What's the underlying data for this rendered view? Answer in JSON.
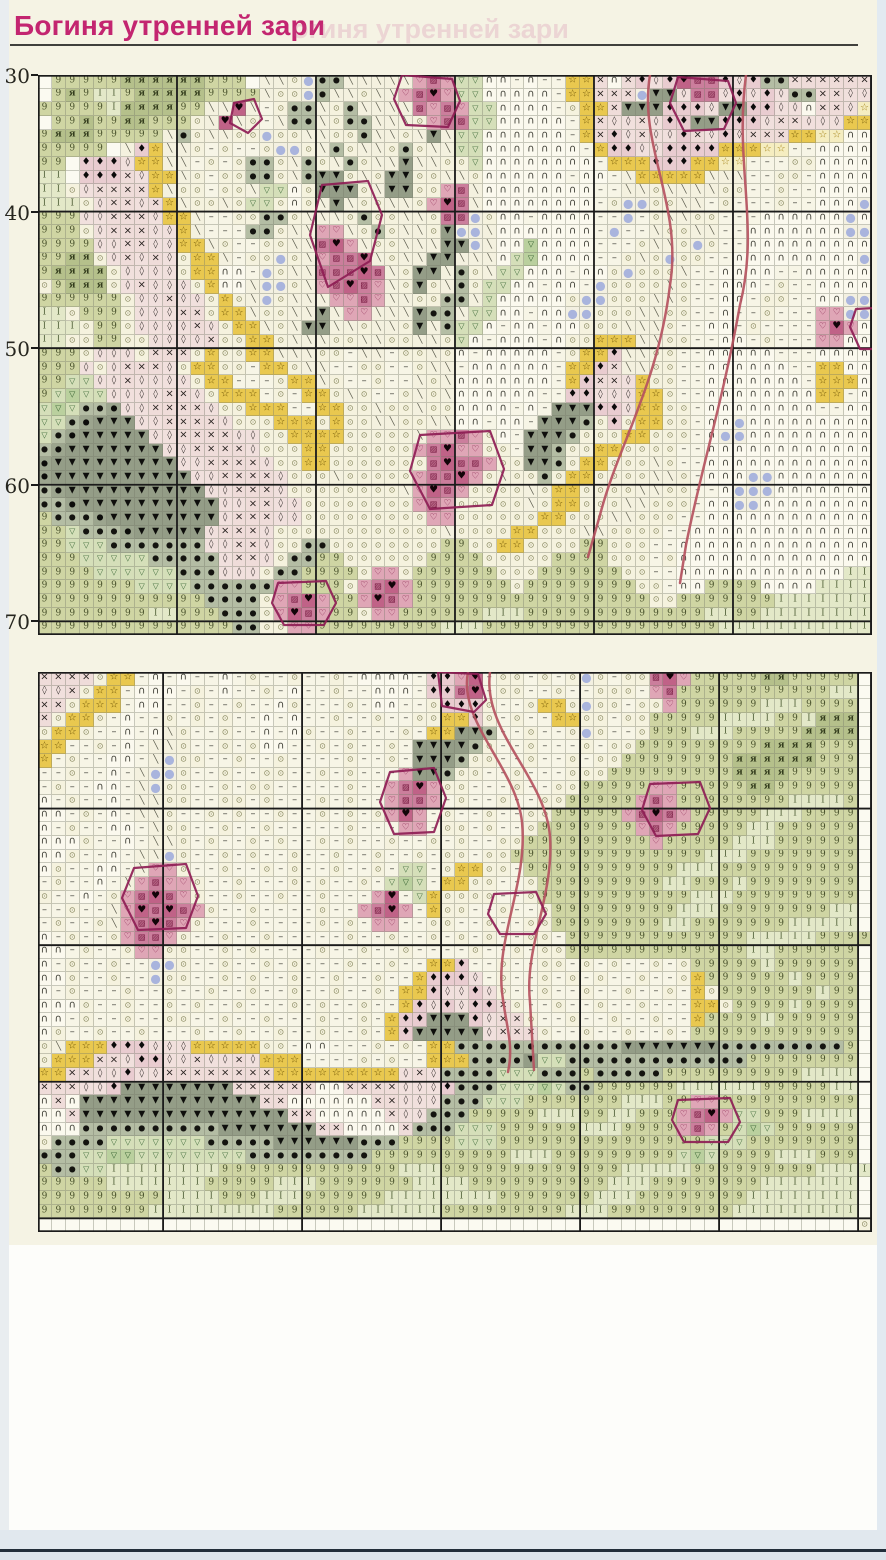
{
  "title": "Богиня утренней зари",
  "ghost_title": "огиня утренней зари",
  "title_color": "#c32570",
  "row_axis": {
    "labels": [
      "30",
      "40",
      "50",
      "60",
      "70"
    ],
    "label_rows": [
      0,
      10,
      20,
      30,
      40
    ]
  },
  "legend": {
    "w": {
      "name": "empty",
      "bg": "#fbfaf1",
      "fg": "#000000",
      "sym": "",
      "fs": 8
    },
    ".": {
      "name": "circled-dot-stitch",
      "bg": "#f5f2de",
      "fg": "#85855c",
      "sym": "⊙",
      "fs": 8
    },
    "-": {
      "name": "dash-stitch",
      "bg": "#f7f5e6",
      "fg": "#46463e",
      "sym": "–",
      "fs": 10
    },
    "n": {
      "name": "arc-stitch",
      "bg": "#fbf9ee",
      "fg": "#38382f",
      "sym": "∩",
      "fs": 10
    },
    "p": {
      "name": "pin-stitch",
      "bg": "#f4f1df",
      "fg": "#5c5c4e",
      "sym": "╲",
      "fs": 9
    },
    "9": {
      "name": "leaf-light-nine",
      "bg": "#cfd5a3",
      "fg": "#47502a",
      "sym": "9",
      "fs": 9,
      "serif": true
    },
    "A": {
      "name": "leaf-dark-ya",
      "bg": "#b5c08b",
      "fg": "#333c1c",
      "sym": "я",
      "fs": 9,
      "serif": true,
      "bold": true
    },
    "I": {
      "name": "leaf-pale-I",
      "bg": "#e3e8c8",
      "fg": "#57663e",
      "sym": "I",
      "fs": 9,
      "serif": true
    },
    "e": {
      "name": "sage-eye-dot",
      "bg": "#b4bda4",
      "fg": "#141410",
      "sym": "●",
      "fs": 8
    },
    "E": {
      "name": "sage-dark-eye-dot",
      "bg": "#9ca58e",
      "fg": "#0c0c0a",
      "sym": "●",
      "fs": 8
    },
    "T": {
      "name": "dark-triangle",
      "bg": "#949d87",
      "fg": "#0e0e0c",
      "sym": "▼",
      "fs": 9
    },
    "v": {
      "name": "green-triangle-light",
      "bg": "#d5dfb9",
      "fg": "#3f6b3a",
      "sym": "▽",
      "fs": 8
    },
    "V": {
      "name": "green-triangle-mid",
      "bg": "#bad09e",
      "fg": "#2e5c2b",
      "sym": "▽",
      "fs": 8
    },
    "y": {
      "name": "gold-star",
      "bg": "#e9c84f",
      "fg": "#6e5404",
      "sym": "☆",
      "fs": 10
    },
    "Y": {
      "name": "pale-star",
      "bg": "#f5edc0",
      "fg": "#a5841a",
      "sym": "☆",
      "fs": 10
    },
    "x": {
      "name": "pink-cross",
      "bg": "#efdcd9",
      "fg": "#26201e",
      "sym": "×",
      "fs": 10
    },
    "q": {
      "name": "pink-lozenge",
      "bg": "#f1e0dd",
      "fg": "#3a3432",
      "sym": "◊",
      "fs": 9
    },
    "D": {
      "name": "black-diamond",
      "bg": "#e9ccd0",
      "fg": "#0b0a0a",
      "sym": "♦",
      "fs": 10
    },
    "h": {
      "name": "rose-open-heart",
      "bg": "#dfa6b6",
      "fg": "#7c1240",
      "sym": "♡",
      "fs": 9
    },
    "r": {
      "name": "rose-hatch-square",
      "bg": "#cb7e9c",
      "fg": "#6e0f36",
      "sym": "▨",
      "fs": 8
    },
    "H": {
      "name": "rose-dark-heart",
      "bg": "#c06287",
      "fg": "#120408",
      "sym": "♥",
      "fs": 10
    },
    "b": {
      "name": "lavender-bead",
      "bg": "#f3f0e1",
      "fg": "#a9b4dd",
      "sym": "●",
      "fs": 12
    },
    "B": {
      "name": "lavender-bead-green",
      "bg": "#cdd7af",
      "fg": "#9fafdc",
      "sym": "●",
      "fs": 12
    }
  },
  "panels": [
    {
      "id": "panel1",
      "top": 75,
      "thick_cols": [
        0,
        10,
        20,
        30,
        40,
        50,
        60
      ],
      "thick_rows": [
        0,
        10,
        20,
        30,
        40
      ],
      "rows": [
        "w99999AAAAAA999wpp.beeppppphrhvvnn-n--yyxnxDqDHrrDqDeexxxxxx",
        "w9A9II9AAAAA9999p..bepp.pphrHhvvnnnnn-yyxxxbTTqrrqDqDqeexxqq",
        "99999IAAAA99ppHp-.eep.epppprhrhvvnnnn-.yyxTTTDDDqTTDDqqnxxqY",
        "w99A99AA999.pHp.-peep.eeppp.hrrvvnnnnn-yxqqxqDDTTDDDqxxqqqyy",
        "9AAA99999pe.pp..b..pp..epp.pTpvvnnnnnn-yxDqxqqDxqDqxxxyyYYnn",
        "99999wpDypp.-.--.bb.pe.pp.e.ppvvnnnnnnn-yDDqqDDDDyyyYY--nnnn",
        "99wDDDqyypp-.-.ee.pe.pe.ppTpp..vnnnnnnnn-yyyDDDyyYY---..nnnn",
        "IIwDDDxqyyp.-..ee.peTT.p.TT..pp.nnnnnn-nn-pyyyyyppp--..-nnnn",
        "II.qxxxxyp..-..pvvn.TTT.pTT..hrpnnnnnnnn--pp.pppp..--.--nnnn",
        "III.qxxqxyp..p.vv.n.pTp..pp.hHrpnnnnnnnn-.bb..pp-.---.--nnnb",
        "999qqxxxqyyp--..ee.ppp.e..pp.rrb.nn-nnnn--b-.pp..---nnnnnnbn",
        "999.qxxxqqyp---ee.pphhp.e.pp.Tbbpnnnnnnn-b--p..pp--nnnnnnnbb",
        "9999qqxxqqyyp.--..pprHhp..pppTTbpnnVnnnn---.pp.b.--nnnnnnnnn",
        "99AA.qxqxq.yyp-..b.phrrHp.ppTTpppnvVnnnn--.p.b..--nnnnnnnnnb",
        "9AAAA.qqqq.yynn-b.pprrrHrp.TTpe.pvvnnn-nn.b...p--nnnn--nnnnn",
        ".9AAA.qxqqq.ynnpbb.phrHrhp.T.pe.vvnn-nn-b....p.--nnn-.--nnnn",
        "999999.qqxqq.y.pb.ppphhrhpp..eepvnnnnn.bb...pp.--nn-..--nnbb",
        "II.999.qqqxx.yyp..ppTphhpppTeepvvnn-nnbb...pp..--n--.---hhbb",
        "III.99.qqqqxq.yyp.pTTpp.pp.Tpevvn-nn-nn...ppp.--nn-.----hHhn",
        "II..99..qqqqx..yy.ppp..pp..pp.vn-nnn-n..yyypp..--nn-.---hhnn",
        "999.qqq.xxx.y..yyppp..-pp-..p.n-nnnnn-.yyDpp..--nnnnn---nnnn",
        "999q.qxxxq.yy..-yy.pp--..--.pp-nnnnnn-yyDxpp..--nnnnnn--yynn",
        "99vvqqxqqqq.yy---.yyp.--.--p.pnnnnnnn-yDxxqy..--nnnnnnn-yyyn",
        "9vVvvqqqqxxq.yyy-.-yy.p.--.p.pnnnnnn--DDqqqyy.--nnnnnnnnyy-n",
        "vVveeEqqxxxxq..yyy--yy..p..p..nnnn-n-TTTDDqyy..-nnnnnnnn--nn",
        "vveETTTqqxxxxq...yyy.y..pp..ppnn-nn-TTTe.D.yy..-nnbnnnnnnnnn",
        "veETTTTTqqxxxxqq..yyyy.....phhrh.n-TTTe...yy...-nbbnnnnnnnnn",
        "eETTTTTTTqqxxxxq...yy......hrHhh..-TTe..yy....--nnnnnnnnnnnn",
        "ETTTTTTTTTqqxxxxq..yy.......rHrrh..TTe.yy...p.--nnnnnnnnnnnn",
        "ETTTTTTTTTTqqxxxxq...p.....hrrHh.p..e.yy....pp.-nnnbbnnnnnnn",
        "eETTTTTTTTTTqqxxxq........phHrh....p.yy....pp..--nbbbnnnnnnn",
        "eeETTTTTTTTTTqqxxqq........hrh.....p.yy...pp...-nnbbnnnnnnnn",
        "9eeeETTTTTTTTqxxxqq.........hh......yy...pp...--nnnnnnnnnnnn",
        "99veeeETTTTTqxxxq............p....yy...pp....--nnnnnnnnnnnnn",
        "99vvveeeeeeeqqxxq..ee........99..yy....99...--nnnnnnnnnnnnnn",
        "999vvvvveeeeeqxxq.ee99......9999.....9999...-.nnnnnnnnnnnnnn",
        "9999vvvvvveeeqqq.ee9999.hh.999999...999999..--nnnnnnnnnnnnII",
        "9999999vvvveeeeeehh999.hrHh9999999.99999999..-nn9999nnnnIIII",
        "999999999999eeee.hrHh99hHrh99999999999999999..9999999IIIIIII",
        "99999999II999eee.hHrh99.hh999999III9999999999999II99IIIIIIII",
        "99999999999999ee..hh999999999III99999999999999999IIIIIIIIIII"
      ],
      "backstitch": [
        {
          "color": "#b5525f",
          "width": 2.5,
          "path": "M612,0 C600,70 645,130 632,210 C620,310 580,370 562,440 L550,482"
        },
        {
          "color": "#b5525f",
          "width": 2.5,
          "path": "M708,0 C696,90 722,150 702,230 C684,330 664,390 648,470 L642,508"
        },
        {
          "color": "#8e1d55",
          "width": 2.2,
          "path": "M364,0 L414,4 L422,26 L410,52 L368,50 L356,24 Z"
        },
        {
          "color": "#8e1d55",
          "width": 2.2,
          "path": "M284,110 L330,106 L344,140 L332,186 L290,212 L272,160 Z"
        },
        {
          "color": "#8e1d55",
          "width": 2.2,
          "path": "M640,2 L690,6 L698,28 L686,54 L646,56 L632,28 Z"
        },
        {
          "color": "#8e1d55",
          "width": 2.2,
          "path": "M818,234 L856,232 L864,254 L854,274 L822,274 L812,252 Z"
        },
        {
          "color": "#8e1d55",
          "width": 2.2,
          "path": "M382,360 L452,356 L466,394 L454,430 L392,434 L372,396 Z"
        },
        {
          "color": "#8e1d55",
          "width": 2.2,
          "path": "M240,508 L288,506 L298,528 L286,550 L246,550 L234,528 Z"
        },
        {
          "color": "#8e1d55",
          "width": 2.2,
          "path": "M196,28 L216,24 L224,44 L210,58 L192,48 Z"
        }
      ]
    },
    {
      "id": "panel2",
      "top": 672,
      "thick_cols": [
        0,
        9,
        19,
        29,
        39,
        49,
        59,
        60
      ],
      "thick_rows": [
        0,
        10,
        20,
        30,
        40
      ],
      "rows": [
        "xxxx.yy-n-n--n-.--.--.-nnnn-DDhH-..-.-.b.-..rHh99999AA99999w",
        "qqx.yy-nnn-.-n--.-n--.--nnn-DDrH-..--.--...-hr99999999999IIw",
        "xx.yyy-nn--.--.--n.---.-nn--.DDD.--.yy.b..-..h999999III9999w",
        "x.yy.-n--.-.-.--n-n--.--.--..yyD.-.--yy..-..99999IIII99IAAAw",
        ".yy.--n-np.--.--n-n.--.---.-yyTTe--.--.b.--.999III99999AAAAw",
        "yy--.-n-pp.--.-.nn--.-.--.-TTTTe.--.---.-..999999999AAAA999w",
        "y-.--nn-pb..--.--.----.--.-TTTe..--.--.-..99999999AAAAAA999w",
        "--.--n-pbb.--.--..--.-.---hTTe..--.---...999999999AAAA99999w",
        "-.--nn-pb..--.-..-----.--hrHh..---.--..99999hh99999AA999999w",
        "n-.--n-pp..--..-.---.-.--hrrh-.--.--..99999hrh99999999IIII9w",
        "nn-.-n-pp.--.-.--.--.-.-.hHh-.--.--..99999hrHrh99999III9999w",
        "n-.--nn-p..--.--.-----.---hh-..-.--.9999999hrh99999II999999w",
        "nnn.--n-pp.-.--.-.--.-.--.--.-.--..999999999h99999III999999w",
        "nn.--n-ppb.--.-.--.--.--.--.-..-..99999999999999III99999999w",
        "n.--nn-phh.--.--.-.--.--.-vv-.yy..-99999999999III9999999999w",
        "-.--n-phrhh.--.---.-.--.-vVv-yy..--.999999999II999I99999999w",
        ".--n-.hrHrh.--.--.--.---hH-vy....--.99999999999III999999999w",
        "--.--phHrHrh.--.----.--hrHh-y..--.--.999999999III99999999IIw",
        "-.--.phrHrh.---.----.-.-hh--..--.--..99999999II9999999IIIIIw",
        "n-.--.hrrh.--.--.-----.--.--.-.-.--..-9999999999999II III9999w",
        "nn-.--.hh..--.-.----.--.--.----.--.-..999999999999 9II999999w",
        "n-.--.--bb.--.--.-.---.--.--yyD--.--..-.-.--.-.99999I999999w",
        "nn.--.--b..--.-.--.--.--.--yDDDq-.--.-.-.--.--.y999999I9999w",
        "n-.---.--.--.--.--.--.--.-yyDqqDq.--.--.--.--.-y.9999999I99w",
        "nnn.--.--.-.--.---.-.--.--yDqDqDDx.--.--.--.---yy.9999I9999w",
        "nn-.--.--..--.--.---.--.-yDDTTTDqxx.--.--.--.--y9999I999999w",
        "n.--.--.---.--.--.--.--.-yDTTTTTqxxx.--.--.--.-999999999999w",
        ".pyyyDDDqqqyyyyy..-nn---.-.-yyeeeeeeeeeeeeTTTTTTTeeeeeeeee9w",
        ".yyyxxqDDqqxqqxqyyy----.-.--yyyeeeeTvveeeeeeeeeeeee99999999w",
        "yyxxqqDqqxxxxxxxxyyyyyyyyyqxqeeeevvveee9eeeee9999999999IIIIw",
        "xxxqqDTTTTTTTTxxxxxxnnxxxxqqqDeeevvvVvee999999IIIIII99999IIw",
        "nxnTTTTTTTTTTTTTxxnnnnnnxxqqqeeevvv9999999III99hh9999999999w",
        "nnxTTTTTTTTTTTTTTTxxnnnnnxqqeee99999III99II999hrHhvv999IIIIw",
        "nnneeeeeeeeeeTTTTTTTxxnnnnxeeevvv999999III9999hrh9vVv999999w",
        ".eeeevvvvvvveeeeeTTTTTTeee9999vvv999999999999999vvv99999999w",
        "eeevvVVvvvvvvvveeeeeeeee9999999999III999999999vVv9999III999w",
        "9eevvIIIIIIII9999999999999III9999999999999II III999999999IIIIIw",
        "99999IIIIIII99999III9999999IIII9999999999III99999999IIIIIIIw",
        "999999999IIII999III999999IIIIIIII9999999III99999999IIIIIIIIw",
        "99999999IIIIIIIII999999IIIIII999999999III999999999IIIIIIIIIw",
        "wwwwwwwwwwwwwwwwwwwwwwwwwwwwwwwwwwwwwwwwwwwwwwwwwwwwwwwwwww"
      ],
      "backstitch": [
        {
          "color": "#b5525f",
          "width": 2.5,
          "path": "M430,0 C420,50 478,95 484,150 C490,210 458,265 464,320 C468,355 476,372 470,400"
        },
        {
          "color": "#b5525f",
          "width": 2.5,
          "path": "M452,0 C444,60 508,105 512,165 C516,225 486,275 492,330 L496,398"
        },
        {
          "color": "#8e1d55",
          "width": 2.2,
          "path": "M400,0 L440,2 L448,28 L436,40 L404,34 Z"
        },
        {
          "color": "#8e1d55",
          "width": 2.2,
          "path": "M352,100 L396,96 L408,126 L396,160 L356,162 L342,130 Z"
        },
        {
          "color": "#8e1d55",
          "width": 2.2,
          "path": "M96,196 L148,192 L160,224 L148,256 L100,258 L84,226 Z"
        },
        {
          "color": "#8e1d55",
          "width": 2.2,
          "path": "M612,112 L662,110 L672,136 L660,162 L618,164 L604,138 Z"
        },
        {
          "color": "#8e1d55",
          "width": 2.2,
          "path": "M456,222 L498,220 L508,242 L496,262 L462,262 L450,242 Z"
        },
        {
          "color": "#8e1d55",
          "width": 2.2,
          "path": "M640,428 L692,426 L702,450 L690,470 L646,470 L634,448 Z"
        }
      ]
    }
  ]
}
